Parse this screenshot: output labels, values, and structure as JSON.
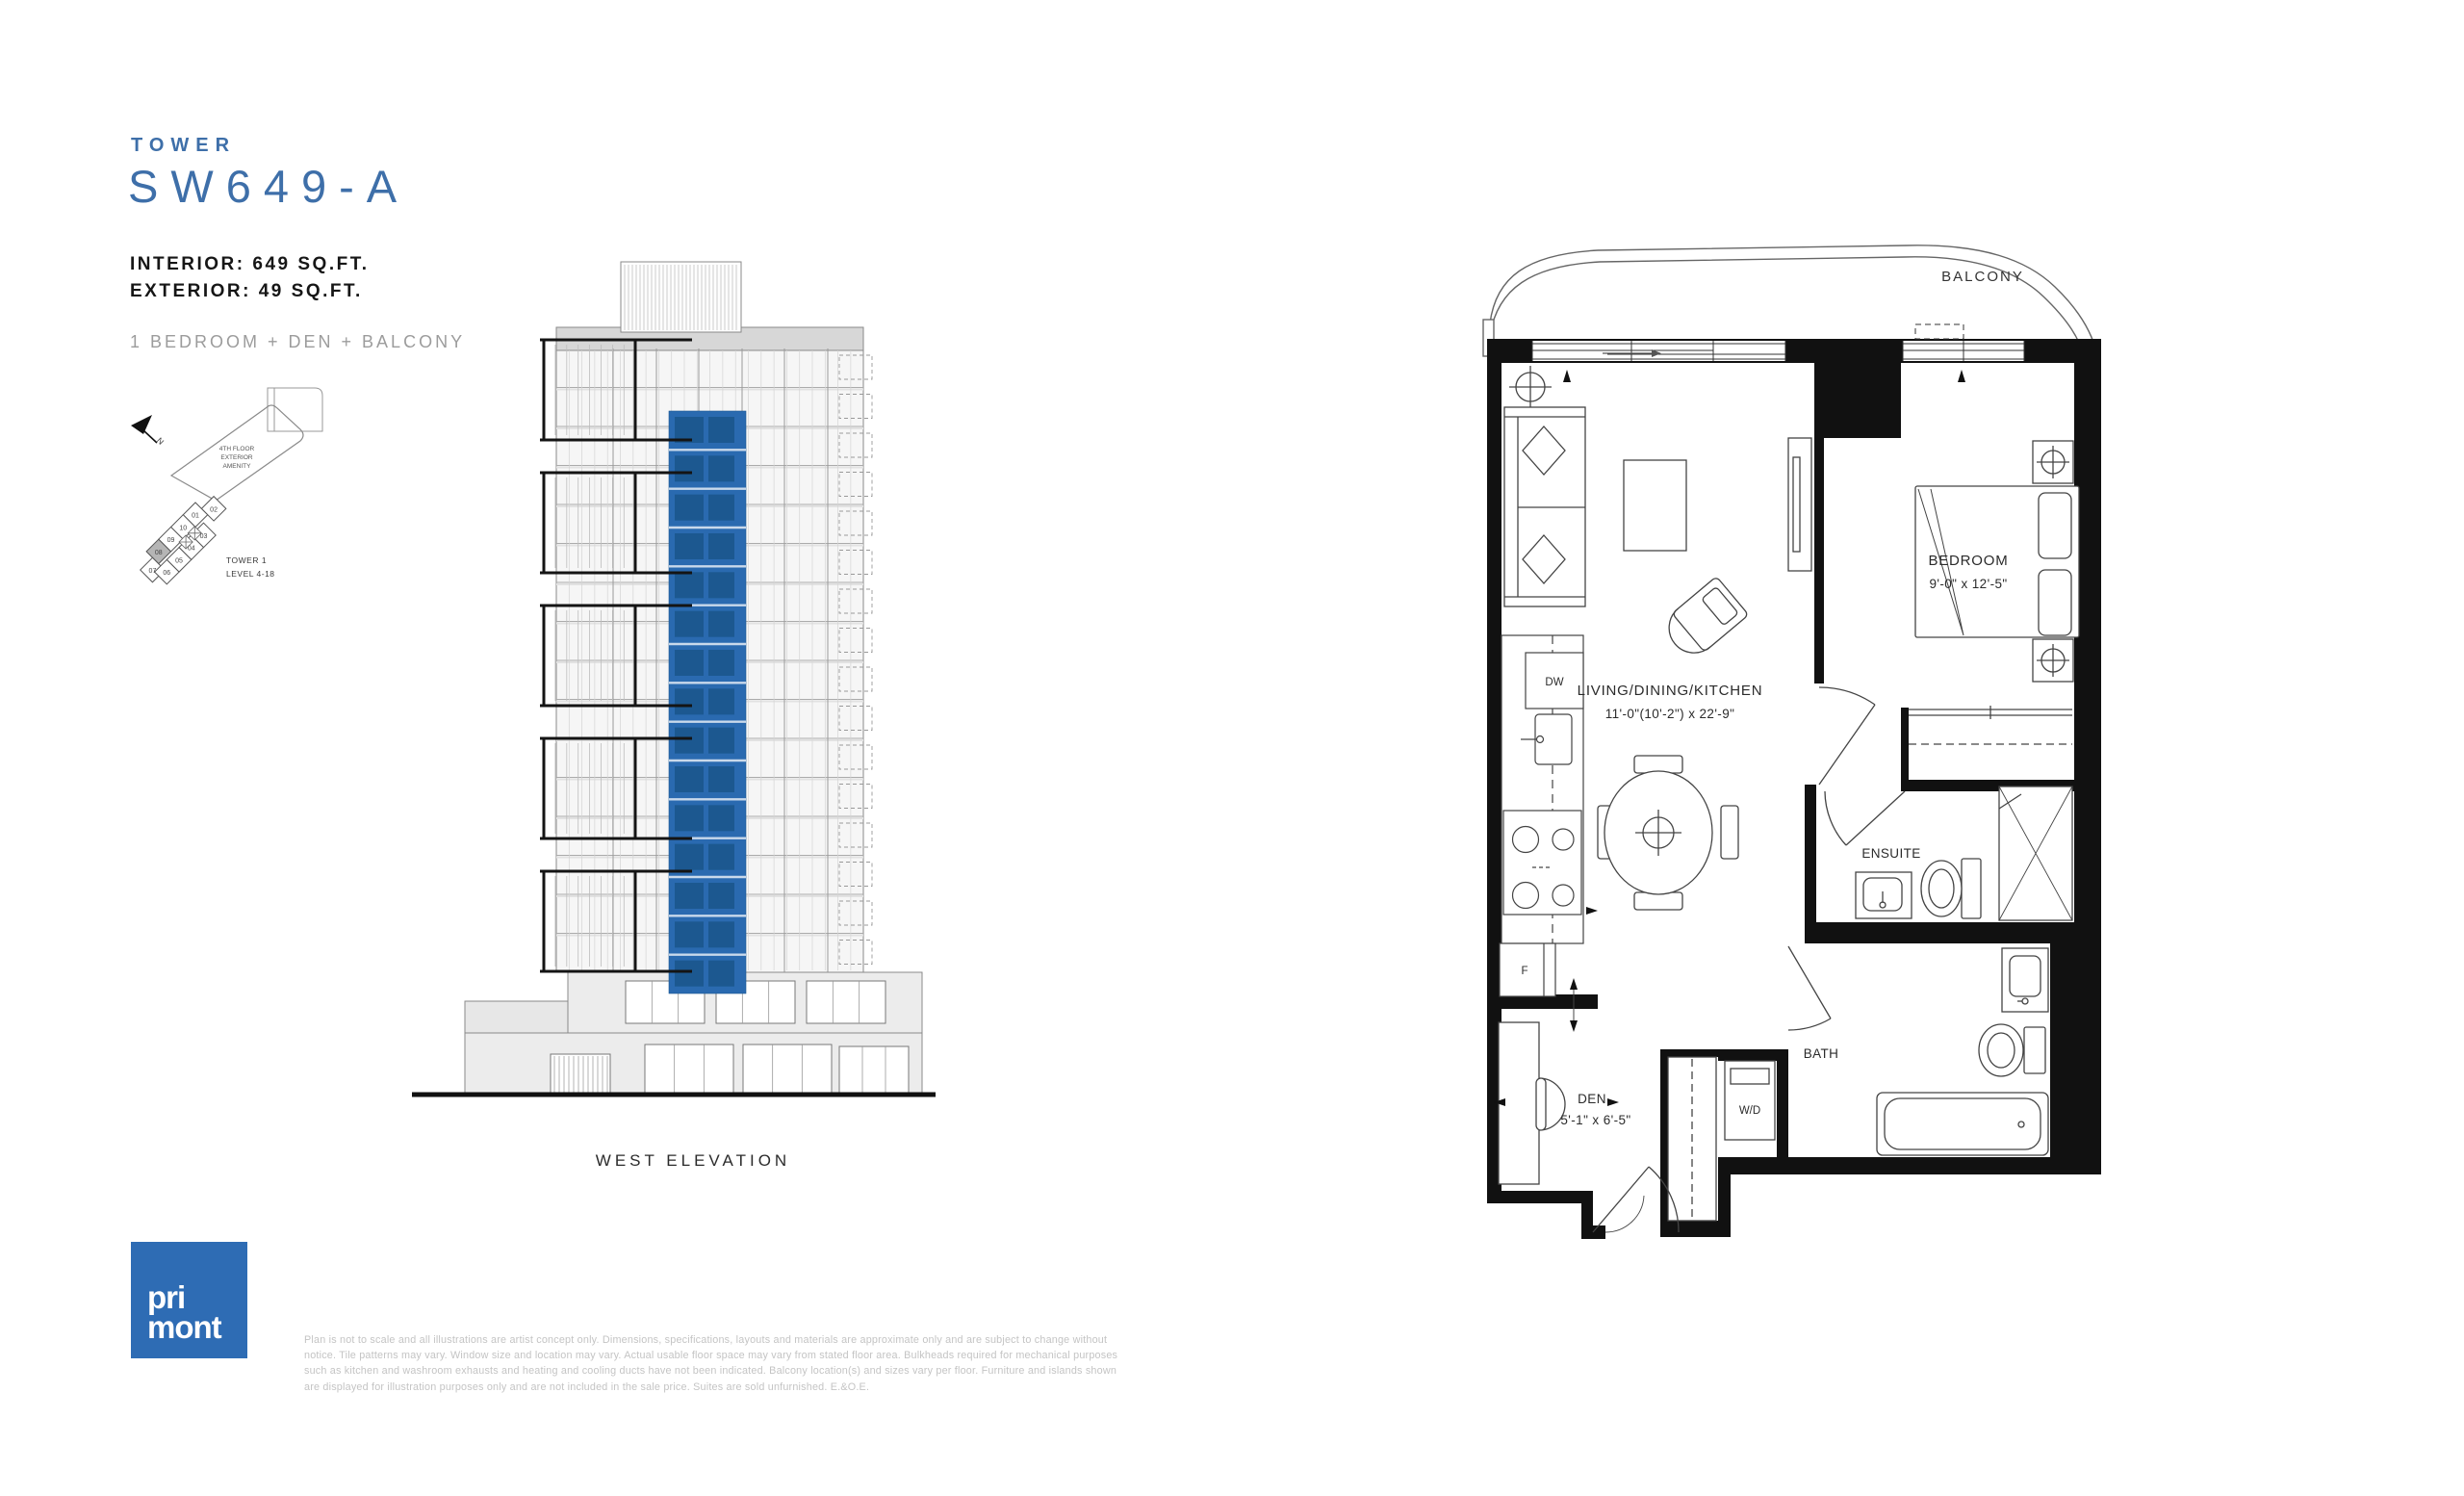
{
  "header": {
    "eyebrow": "TOWER",
    "plan_name": "SW649-A",
    "interior": "INTERIOR: 649 SQ.FT.",
    "exterior": "EXTERIOR: 49 SQ.FT.",
    "suite_type": "1 BEDROOM + DEN + BALCONY"
  },
  "keyplan": {
    "north": "N",
    "amenity": [
      "4TH FLOOR",
      "EXTERIOR",
      "AMENITY"
    ],
    "tower": "TOWER 1",
    "level": "LEVEL 4-18",
    "units": [
      "01",
      "02",
      "03",
      "04",
      "05",
      "06",
      "07",
      "08",
      "09",
      "10"
    ],
    "highlighted_unit": "08"
  },
  "elevation": {
    "caption": "WEST ELEVATION"
  },
  "floorplan": {
    "balcony": "BALCONY",
    "bedroom_name": "BEDROOM",
    "bedroom_dims": "9'-0\" x 12'-5\"",
    "living_name": "LIVING/DINING/KITCHEN",
    "living_dims": "11'-0\"(10'-2\") x 22'-9\"",
    "ensuite": "ENSUITE",
    "den_name": "DEN",
    "den_dims": "5'-1\" x 6'-5\"",
    "wd": "W/D",
    "bath": "BATH",
    "dishwasher": "DW",
    "fridge": "F"
  },
  "logo": {
    "line1": "pri",
    "line2": "mont"
  },
  "disclaimer": "Plan is not to scale and all illustrations are artist concept only. Dimensions, specifications, layouts and materials are approximate only and are subject to change without notice. Tile patterns may vary. Window size and location may vary. Actual usable floor space may vary from stated floor area. Bulkheads required for mechanical purposes such as kitchen and washroom exhausts and heating and cooling ducts have not been indicated. Balcony location(s) and sizes vary per floor. Furniture and islands shown are displayed for illustration purposes only and are not included in the sale price. Suites are sold unfurnished. E.&O.E.",
  "colors": {
    "accent_blue": "#3E6FA9",
    "logo_blue": "#2E6CB4",
    "elevation_highlight": "#2A6AB0",
    "elevation_highlight_dark": "#1C5890",
    "wall_black": "#111111",
    "muted_gray": "#9C9C9C",
    "fineprint_gray": "#C4C4C4"
  }
}
